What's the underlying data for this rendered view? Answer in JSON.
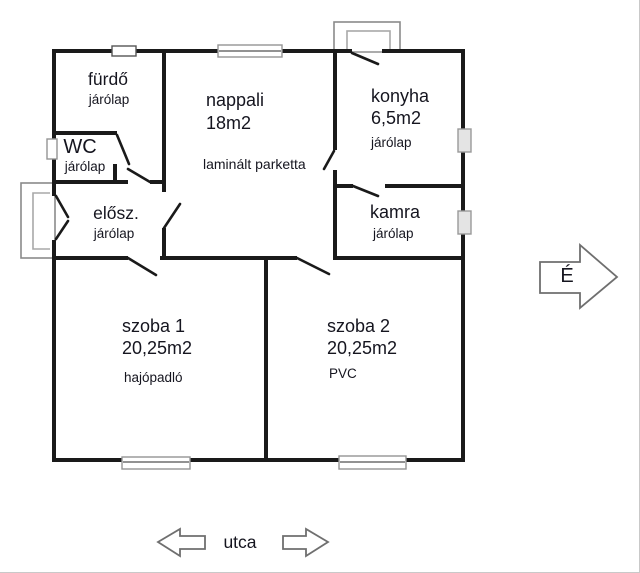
{
  "plan": {
    "title": "apartment floor plan",
    "rooms": [
      {
        "id": "furdo",
        "name": "fürdő",
        "floor": "járólap"
      },
      {
        "id": "wc",
        "name": "WC",
        "floor": "járólap"
      },
      {
        "id": "eloszoba",
        "name": "elősz.",
        "floor": "járólap"
      },
      {
        "id": "nappali",
        "name": "nappali",
        "area": "18m2",
        "floor": "laminált parketta"
      },
      {
        "id": "konyha",
        "name": "konyha",
        "area": "6,5m2",
        "floor": "járólap"
      },
      {
        "id": "kamra",
        "name": "kamra",
        "floor": "járólap"
      },
      {
        "id": "szoba1",
        "name": "szoba 1",
        "area": "20,25m2",
        "floor": "hajópadló"
      },
      {
        "id": "szoba2",
        "name": "szoba 2",
        "area": "20,25m2",
        "floor": "PVC"
      }
    ],
    "compass": {
      "label": "É"
    },
    "street": {
      "label": "utca"
    },
    "colors": {
      "wall": "#1a1a1a",
      "text": "#15151f",
      "window_frame": "#949494",
      "background": "#ffffff"
    }
  }
}
